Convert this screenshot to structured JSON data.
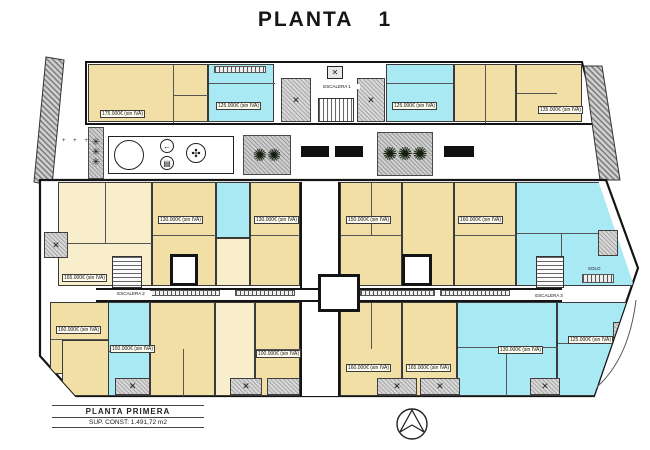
{
  "sheet": {
    "title": "PLANTA 1"
  },
  "title_block": {
    "name": "PLANTA PRIMERA",
    "area": "SUP. CONST: 1.491,72 m2"
  },
  "plan": {
    "stairwells": {
      "s1": "ESCALERA 1",
      "s2": "ESCALERA 2",
      "s3": "ESCALERA 3"
    },
    "notes": {
      "solo": "SOLO"
    },
    "colors": {
      "unit_warm": "#f2dfa6",
      "unit_warm_light": "#f8eecb",
      "unit_cool": "#a9e9f3",
      "terrace_gray": "#d8d8d8",
      "wall": "#141414"
    },
    "price_labels": [
      "175.000€ (sin IVA)",
      "125.000€ (sin IVA)",
      "125.000€ (sin IVA)",
      "135.000€ (sin IVA)",
      "165.000€ (sin IVA)",
      "130.000€ (sin IVA)",
      "130.000€ (sin IVA)",
      "150.000€ (sin IVA)",
      "160.000€ (sin IVA)",
      "160.000€ (sin IVA)",
      "150.000€ (sin IVA)",
      "100.000€ (sin IVA)",
      "160.000€ (sin IVA)",
      "165.000€ (sin IVA)",
      "130.000€ (sin IVA)",
      "125.000€ (sin IVA)"
    ],
    "icon_glyphs": {
      "table": "✕",
      "palm": "✺",
      "plant": "✳",
      "arrow": "←",
      "grill": "▤",
      "flower": "✣",
      "lift": "✕"
    }
  }
}
